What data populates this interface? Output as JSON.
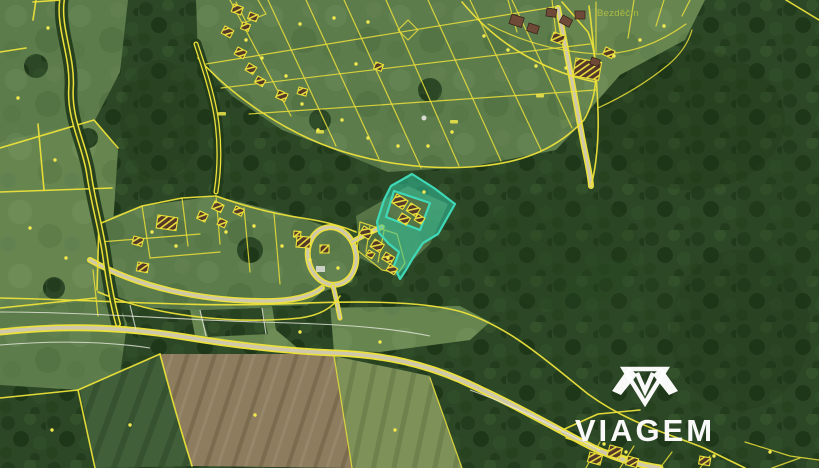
{
  "map": {
    "place_label": "Bezděčín",
    "highlighted_parcel_color": "#2fc7a3",
    "cadastral_line_color": "#ece13a"
  },
  "watermark": {
    "brand": "VIAGEM"
  },
  "colors": {
    "cadastral": "#ece13a",
    "highlight": "#2fc7a3",
    "highlight-stroke": "#3fd9b8",
    "road": "#cfc8ad",
    "white-line": "#e9e9df",
    "label": "#b4c040",
    "watermark": "#ffffff"
  }
}
